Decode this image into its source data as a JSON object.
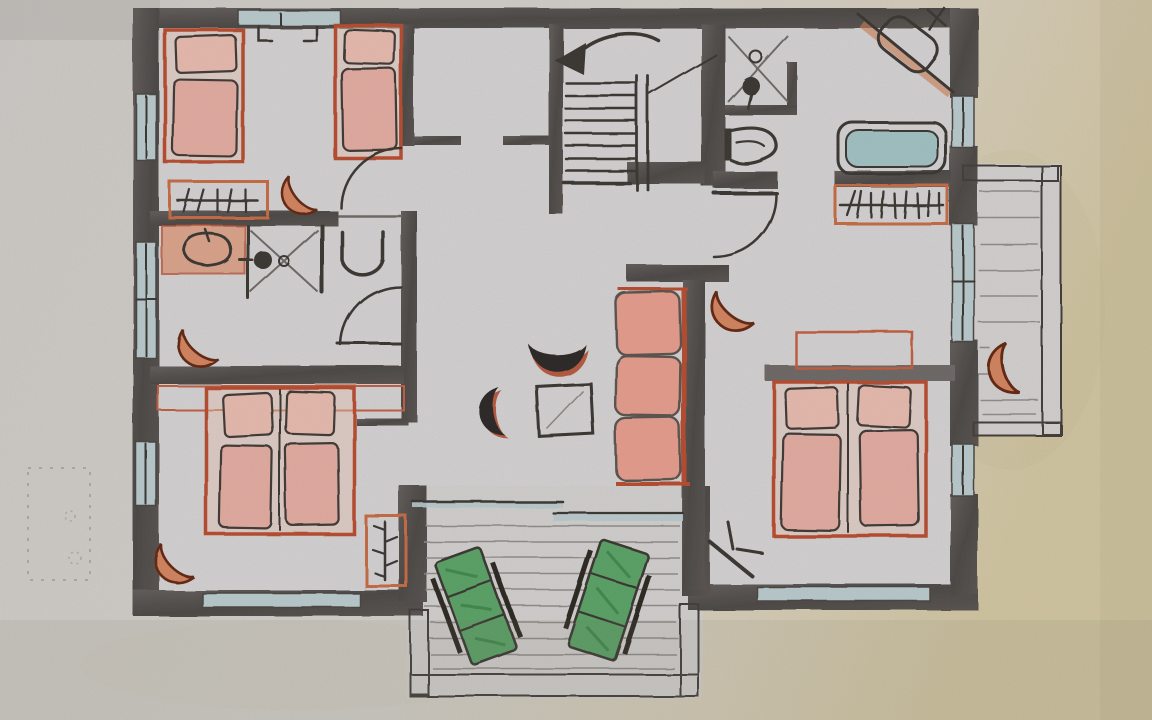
{
  "document": {
    "title": "Hand-drawn floor plan sketch in pencil and coloured crayon (photo of paper)",
    "visible_text": [],
    "notes": "No readable text on the sheet; only faint erased pencil marks near the lower-left margin."
  },
  "palette": {
    "paper": "#cfcac3",
    "paper-warm": "#d2c5a2",
    "plan-bg": "#d3d1d2",
    "ink": "#35302e",
    "wall-dark": "#474341",
    "wall-mid": "#5a5553",
    "window": "#b7c9cd",
    "tub": "#9fc0c2",
    "deck": "#8d8987",
    "bed-red": "#b5472c",
    "bed-pink": "#e2aaa0",
    "bed-pink-light": "#e7b9ad",
    "sofa-pink": "#e59a8a",
    "orange-line": "#c4683f",
    "hatch-orange": "#d08a64",
    "crescent-dark": "#5e2310",
    "crescent-fill": "#d2815b",
    "chair-black": "#272220",
    "lounger-green": "#55a063",
    "lounger-green-dark": "#2f7a3e"
  },
  "plan": {
    "rooms": [
      {
        "id": "bedroom-top-left",
        "furniture": [
          "single-bed",
          "single-bed",
          "radiator",
          "crescent-chair",
          "door-swing",
          "wall-hooks",
          "window"
        ]
      },
      {
        "id": "bathroom-left",
        "furniture": [
          "washbasin",
          "shower",
          "toilet",
          "crescent-chair",
          "door-swing",
          "window"
        ]
      },
      {
        "id": "bedroom-bottom-left",
        "furniture": [
          "double-bed",
          "headboard",
          "radiator",
          "crescent-chair",
          "window"
        ]
      },
      {
        "id": "stair-hall",
        "furniture": [
          "staircase",
          "direction-arrow",
          "closet-nook"
        ]
      },
      {
        "id": "bathroom-top-right",
        "furniture": [
          "shower",
          "toilet",
          "corner-washbasin",
          "bathtub",
          "radiator",
          "door-swing"
        ]
      },
      {
        "id": "bedroom-right",
        "furniture": [
          "double-bed",
          "headboard-wall",
          "crescent-chair",
          "door-leaf",
          "window"
        ]
      },
      {
        "id": "living-area",
        "furniture": [
          "three-seat-sofa",
          "square-table",
          "moon-chair",
          "moon-chair",
          "sliding-door"
        ]
      },
      {
        "id": "terrace-bottom",
        "furniture": [
          "sun-lounger",
          "sun-lounger",
          "decking",
          "hatched-railing"
        ]
      },
      {
        "id": "balcony-right",
        "furniture": [
          "crescent-chair",
          "decking",
          "hatched-railing",
          "balcony-door"
        ]
      }
    ]
  }
}
